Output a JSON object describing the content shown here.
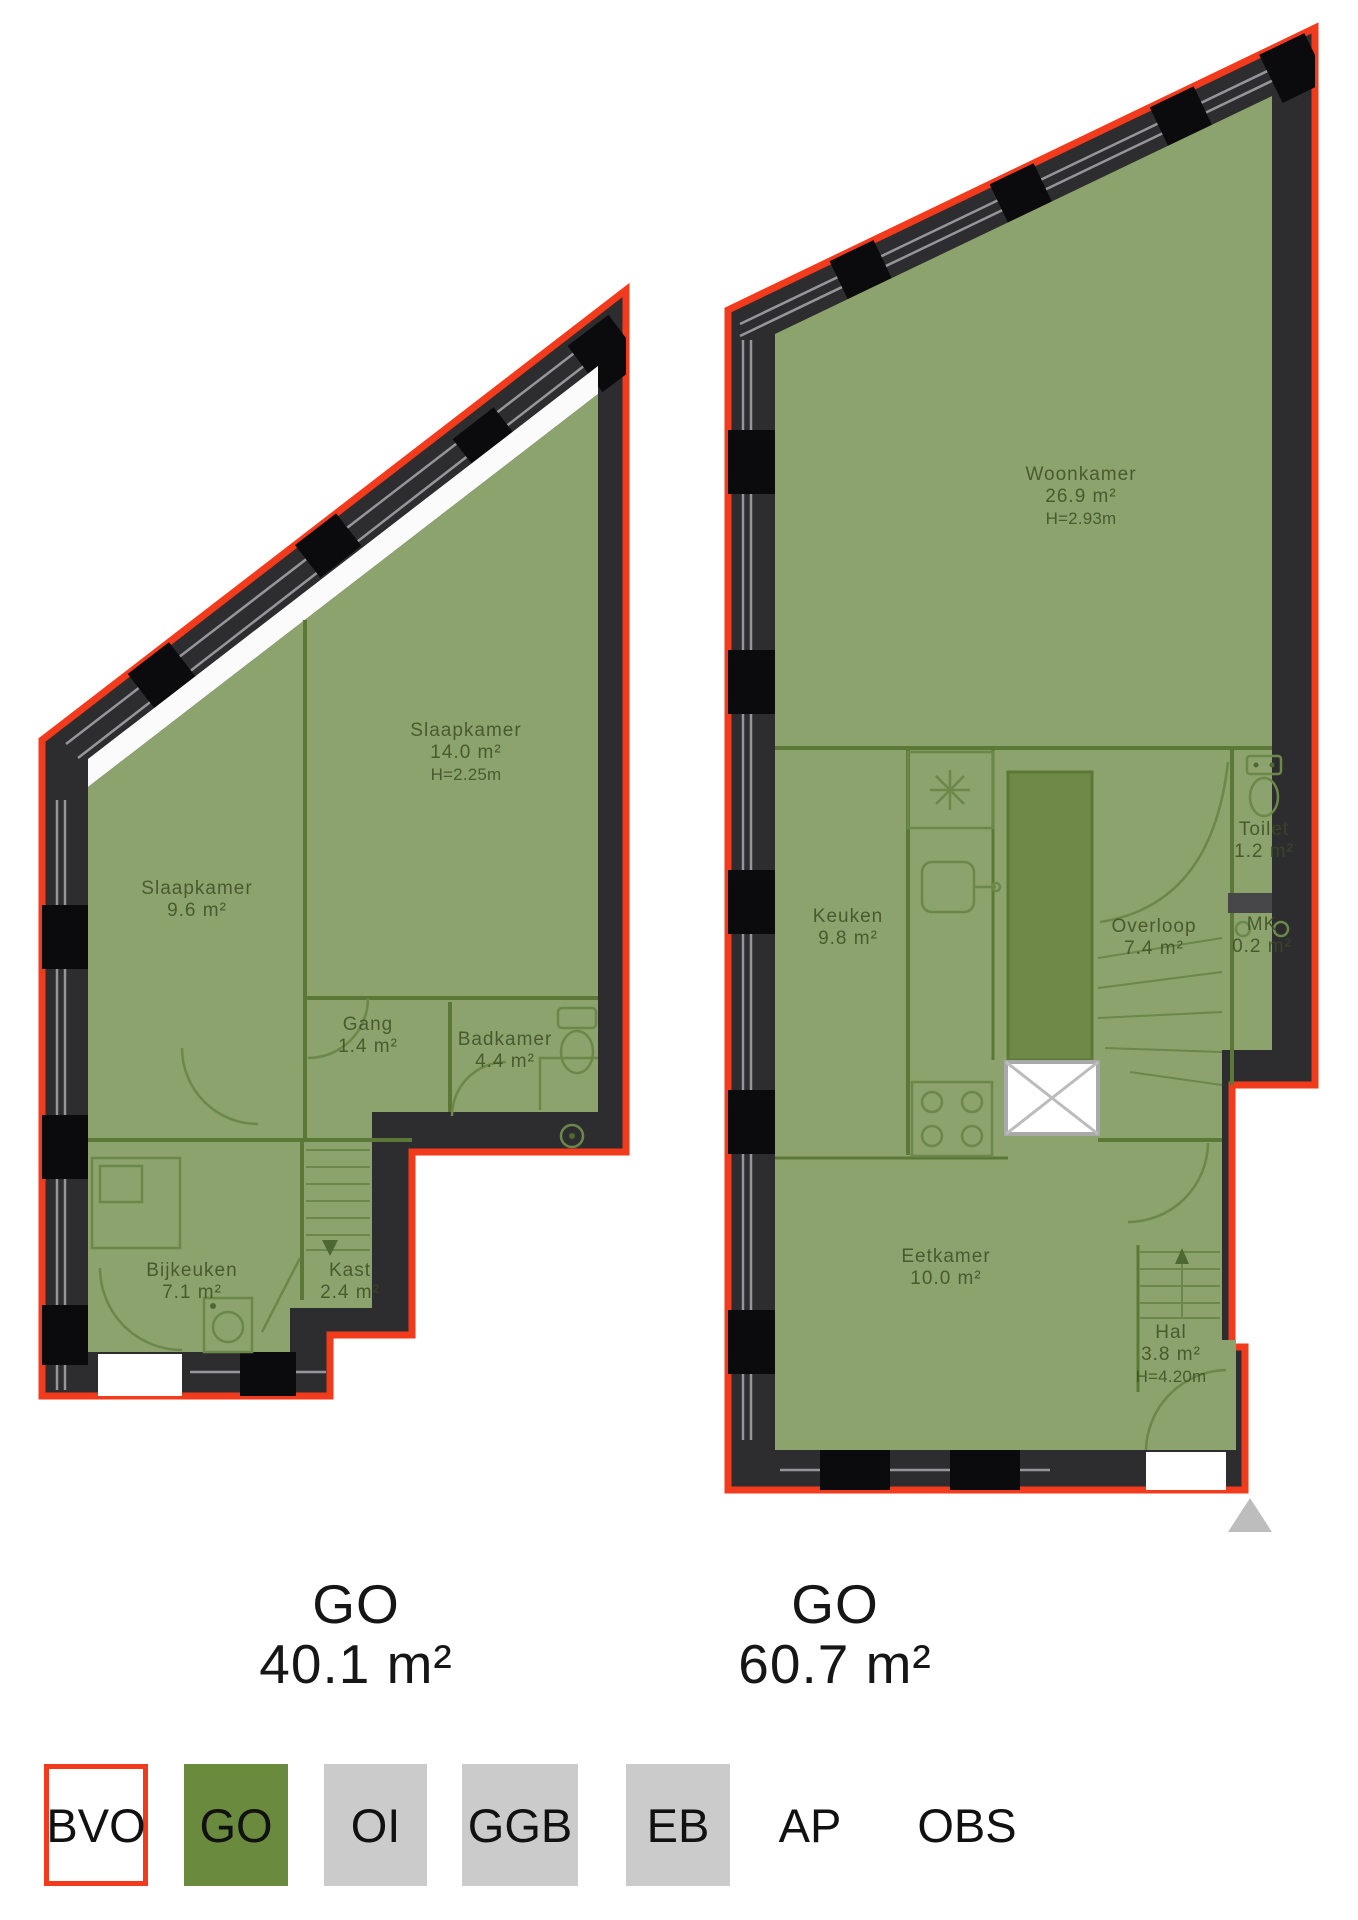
{
  "colors": {
    "bvo_red": "#f23a1c",
    "go_green_plan": "#8ca36d",
    "go_green_legend": "#6a8a3e",
    "wall_dark": "#2d2d30",
    "legend_gray": "#cbcbcb",
    "label_green": "#5a7040"
  },
  "plans": [
    {
      "side": "left",
      "total": {
        "label": "GO",
        "area": "40.1 m²"
      },
      "rooms": [
        {
          "name": "Slaapkamer",
          "area": "14.0 m²",
          "height": "H=2.25m"
        },
        {
          "name": "Slaapkamer",
          "area": "9.6 m²"
        },
        {
          "name": "Gang",
          "area": "1.4 m²"
        },
        {
          "name": "Badkamer",
          "area": "4.4 m²"
        },
        {
          "name": "Bijkeuken",
          "area": "7.1 m²"
        },
        {
          "name": "Kast",
          "area": "2.4 m²"
        }
      ]
    },
    {
      "side": "right",
      "total": {
        "label": "GO",
        "area": "60.7 m²"
      },
      "rooms": [
        {
          "name": "Woonkamer",
          "area": "26.9 m²",
          "height": "H=2.93m"
        },
        {
          "name": "Keuken",
          "area": "9.8 m²"
        },
        {
          "name": "Overloop",
          "area": "7.4 m²"
        },
        {
          "name": "Toilet",
          "area": "1.2 m²"
        },
        {
          "name": "MK",
          "area": "0.2 m²"
        },
        {
          "name": "Eetkamer",
          "area": "10.0 m²"
        },
        {
          "name": "Hal",
          "area": "3.8 m²",
          "height": "H=4.20m"
        }
      ]
    }
  ],
  "legend": {
    "items": [
      {
        "code": "BVO",
        "swatch": "outline-red"
      },
      {
        "code": "GO",
        "swatch": "green"
      },
      {
        "code": "OI",
        "swatch": "gray"
      },
      {
        "code": "GGB",
        "swatch": "gray"
      },
      {
        "code": "EB",
        "swatch": "gray"
      },
      {
        "code": "AP",
        "swatch": "none"
      },
      {
        "code": "OBS",
        "swatch": "none"
      }
    ]
  }
}
